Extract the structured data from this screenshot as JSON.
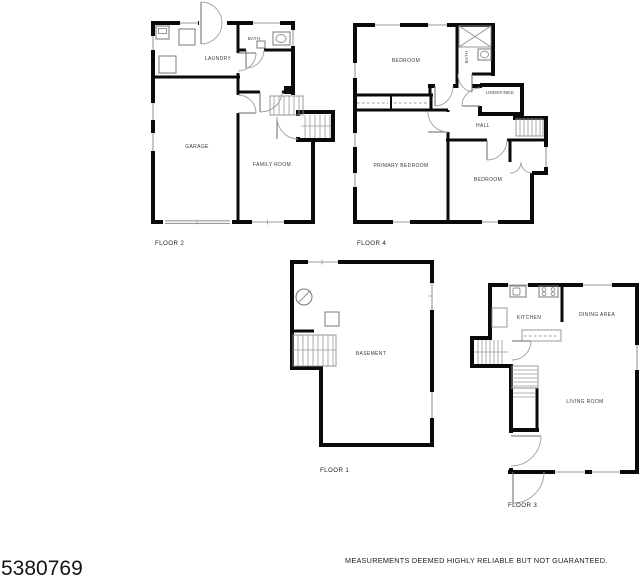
{
  "page": {
    "mls_number": "5380769",
    "disclaimer": "MEASUREMENTS DEEMED HIGHLY RELIABLE BUT NOT GUARANTEED."
  },
  "floors": {
    "floor2": {
      "label": "FLOOR 2",
      "rooms": {
        "laundry": "LAUNDRY",
        "bath": "BATH",
        "garage": "GARAGE",
        "family_room": "FAMILY ROOM"
      }
    },
    "floor4": {
      "label": "FLOOR 4",
      "rooms": {
        "bedroom_top": "BEDROOM",
        "bath": "BATH",
        "undefined_room": "UNDEFINED",
        "hall": "HALL",
        "primary_bedroom": "PRIMARY BEDROOM",
        "bedroom_right": "BEDROOM"
      }
    },
    "floor1": {
      "label": "FLOOR 1",
      "rooms": {
        "basement": "BASEMENT"
      }
    },
    "floor3": {
      "label": "FLOOR 3",
      "rooms": {
        "kitchen": "KITCHEN",
        "dining_area": "DINING AREA",
        "living_room": "LIVING ROOM"
      }
    }
  },
  "colors": {
    "wall": "#0a0a0a",
    "thin_line": "#8f8f8f",
    "text": "#3a3a3a",
    "background": "#ffffff"
  }
}
